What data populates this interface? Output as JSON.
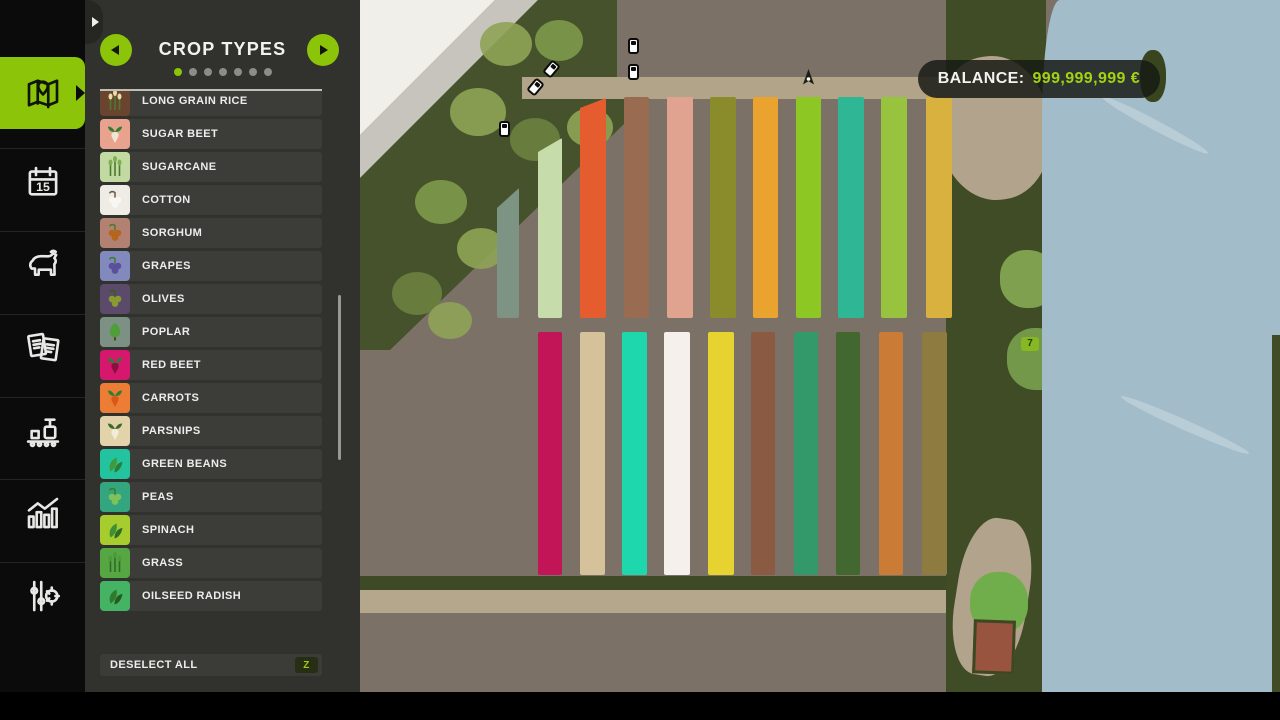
{
  "balance": {
    "label": "BALANCE:",
    "value": "999,999,999 €",
    "value_color": "#a3d211"
  },
  "sidebar": {
    "items": [
      {
        "id": "map",
        "active": true
      },
      {
        "id": "calendar",
        "badge": "15",
        "active": false
      },
      {
        "id": "animals",
        "active": false
      },
      {
        "id": "contracts",
        "active": false
      },
      {
        "id": "production",
        "active": false
      },
      {
        "id": "statistics",
        "active": false
      },
      {
        "id": "settings",
        "active": false
      }
    ]
  },
  "panel": {
    "title": "CROP TYPES",
    "page_dots": {
      "count": 7,
      "active_index": 0
    },
    "crops": [
      {
        "label": "LONG GRAIN RICE",
        "bg": "#6b4430",
        "shape": "grain",
        "c1": "#e9dba6",
        "c2": "#4a7a2e"
      },
      {
        "label": "SUGAR BEET",
        "bg": "#e8a28e",
        "shape": "root",
        "c1": "#efe6d2",
        "c2": "#2e7d32"
      },
      {
        "label": "SUGARCANE",
        "bg": "#c3d9a2",
        "shape": "grain",
        "c1": "#7fae54",
        "c2": "#4a7a2e"
      },
      {
        "label": "COTTON",
        "bg": "#efece6",
        "shape": "berry",
        "c1": "#f8f6f3",
        "c2": "#6b5a4a"
      },
      {
        "label": "SORGHUM",
        "bg": "#b28171",
        "shape": "berry",
        "c1": "#b5651d",
        "c2": "#4a7a2e"
      },
      {
        "label": "GRAPES",
        "bg": "#8289bd",
        "shape": "berry",
        "c1": "#5b4f9e",
        "c2": "#3f7d2a"
      },
      {
        "label": "OLIVES",
        "bg": "#5c4a6b",
        "shape": "berry",
        "c1": "#8a9a30",
        "c2": "#3d5a20"
      },
      {
        "label": "POPLAR",
        "bg": "#7c9184",
        "shape": "tree",
        "c1": "#4e9e3a",
        "c2": "#5a3d20"
      },
      {
        "label": "RED BEET",
        "bg": "#d6176e",
        "shape": "root",
        "c1": "#8a1040",
        "c2": "#2e7d32"
      },
      {
        "label": "CARROTS",
        "bg": "#ed7d35",
        "shape": "root",
        "c1": "#d85818",
        "c2": "#2e7d32"
      },
      {
        "label": "PARSNIPS",
        "bg": "#e3d3ab",
        "shape": "root",
        "c1": "#f2ecd8",
        "c2": "#3d6a28"
      },
      {
        "label": "GREEN BEANS",
        "bg": "#23c3a0",
        "shape": "leaf",
        "c1": "#3f9a3a",
        "c2": "#2e7d32"
      },
      {
        "label": "PEAS",
        "bg": "#33a67f",
        "shape": "berry",
        "c1": "#7fc25c",
        "c2": "#3f7d2a"
      },
      {
        "label": "SPINACH",
        "bg": "#a7cc2d",
        "shape": "leaf",
        "c1": "#3f8f35",
        "c2": "#2e6b28"
      },
      {
        "label": "GRASS",
        "bg": "#56a643",
        "shape": "grain",
        "c1": "#4e9a38",
        "c2": "#2e6b28"
      },
      {
        "label": "OILSEED RADISH",
        "bg": "#45b364",
        "shape": "leaf",
        "c1": "#2f7a2c",
        "c2": "#245c20"
      }
    ],
    "deselect_all": {
      "label": "DESELECT ALL",
      "key": "Z"
    }
  },
  "map": {
    "field_number_badge": "7",
    "fields_top_row": [
      {
        "color": "#7d9383",
        "x": 497,
        "w": 22,
        "top": 188,
        "slant": 1
      },
      {
        "color": "#c7dcab",
        "x": 538,
        "w": 24,
        "top": 138,
        "slant": 2
      },
      {
        "color": "#e55d2e",
        "x": 580,
        "w": 26,
        "top": 98,
        "slant": 3
      },
      {
        "color": "#996b50",
        "x": 624,
        "w": 25,
        "top": 97,
        "slant": 0
      },
      {
        "color": "#dfa390",
        "x": 667,
        "w": 26,
        "top": 97,
        "slant": 0
      },
      {
        "color": "#8a8c2c",
        "x": 710,
        "w": 26,
        "top": 97,
        "slant": 0
      },
      {
        "color": "#eaa32e",
        "x": 753,
        "w": 25,
        "top": 97,
        "slant": 0
      },
      {
        "color": "#8cc724",
        "x": 796,
        "w": 25,
        "top": 97,
        "slant": 0
      },
      {
        "color": "#2fb795",
        "x": 838,
        "w": 26,
        "top": 97,
        "slant": 0
      },
      {
        "color": "#97c33e",
        "x": 881,
        "w": 26,
        "top": 97,
        "slant": 0
      },
      {
        "color": "#d9b13e",
        "x": 926,
        "w": 26,
        "top": 97,
        "slant": 0
      }
    ],
    "fields_top_bottom_y": 318,
    "fields_bottom_row": [
      {
        "color": "#c21558",
        "x": 538,
        "w": 24
      },
      {
        "color": "#d5c29a",
        "x": 580,
        "w": 25
      },
      {
        "color": "#1fd7ad",
        "x": 622,
        "w": 25
      },
      {
        "color": "#f6f0ed",
        "x": 664,
        "w": 26
      },
      {
        "color": "#e7d32f",
        "x": 708,
        "w": 26
      },
      {
        "color": "#8a5a42",
        "x": 751,
        "w": 24
      },
      {
        "color": "#34996a",
        "x": 794,
        "w": 24
      },
      {
        "color": "#42682f",
        "x": 836,
        "w": 24
      },
      {
        "color": "#ca7b36",
        "x": 879,
        "w": 24
      },
      {
        "color": "#8d7b40",
        "x": 922,
        "w": 25
      }
    ],
    "fields_bottom_top_y": 332,
    "fields_bottom_bottom_y": 575,
    "vehicles": [
      {
        "x": 546,
        "y": 61,
        "rot": 40
      },
      {
        "x": 530,
        "y": 79,
        "rot": 40
      },
      {
        "x": 499,
        "y": 121,
        "rot": 0
      },
      {
        "x": 628,
        "y": 38,
        "rot": 0
      },
      {
        "x": 628,
        "y": 64,
        "rot": 0
      }
    ],
    "player_marker": {
      "x": 801,
      "y": 68
    }
  },
  "bottom_bar": {
    "controls": [
      {
        "type": "mouse",
        "label": "ZOOM MAP"
      },
      {
        "type": "mouse",
        "label": "PAN MAP"
      },
      {
        "type": "key",
        "key": "Q",
        "label": "PREVIOUS MENU"
      },
      {
        "type": "key",
        "key": "E",
        "label": "NEXT MENU"
      },
      {
        "type": "key",
        "key": "ESC",
        "label": "BACK",
        "wide": true
      }
    ]
  }
}
